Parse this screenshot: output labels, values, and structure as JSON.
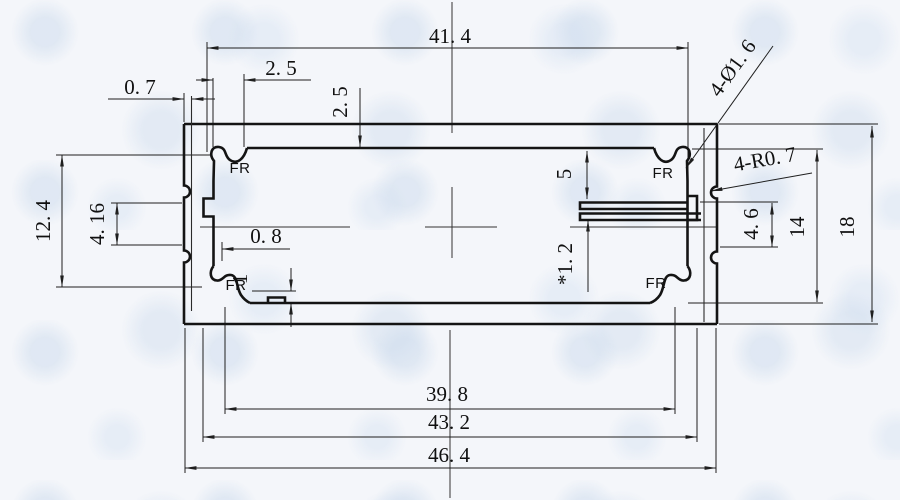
{
  "drawing_colors": {
    "paper": "#f4f6fa",
    "watermark": "#cbdaec",
    "line": "#141414",
    "dimension_line": "#1f1f1f"
  },
  "dims": {
    "width_between_bosses": "41. 4",
    "boss_width": "2. 5",
    "top_wall_depth": "2. 5",
    "side_wall_thickness": "0. 7",
    "boss_spacing_vertical": "12. 4",
    "left_step": "4. 16",
    "rail_offset": "0. 8",
    "rib_height": "1",
    "slot_drop": "5",
    "pcb_slot": "*1. 2",
    "right_step": "4. 6",
    "inner_height": "14",
    "outer_height": "18",
    "bottom_span_inner": "39. 8",
    "bottom_span_mid": "43. 2",
    "bottom_span_outer": "46. 4"
  },
  "leaders": {
    "screw_holes": "4-Ø1. 6",
    "corner_radius": "4-R0. 7"
  },
  "corners": {
    "tl": "FR",
    "tr": "FR",
    "bl": "FR",
    "br": "FR"
  }
}
